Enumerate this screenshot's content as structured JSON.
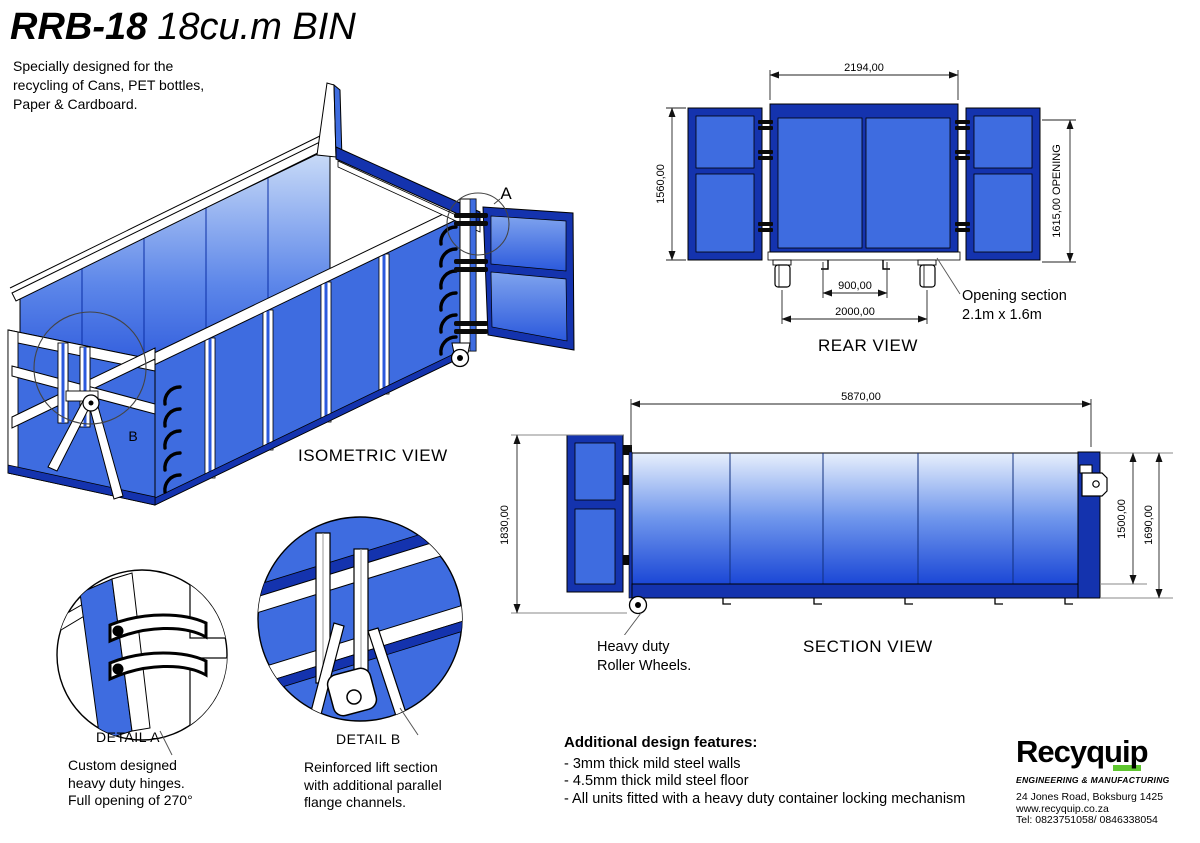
{
  "title": {
    "model": "RRB-18",
    "capacity": "18cu.m BIN"
  },
  "description": "Specially designed for the\nrecycling of Cans, PET bottles,\nPaper & Cardboard.",
  "views": {
    "isometric": {
      "label": "ISOMETRIC VIEW",
      "marker_a": "A",
      "marker_b": "B"
    },
    "rear": {
      "label": "REAR VIEW",
      "dim_width": "2194,00",
      "dim_height": "1560,00",
      "dim_opening": "1615,00 OPENING",
      "dim_wheel_inner": "900,00",
      "dim_wheel_outer": "2000,00",
      "callout": "Opening section\n2.1m x 1.6m"
    },
    "section": {
      "label": "SECTION VIEW",
      "dim_length": "5870,00",
      "dim_height_overall": "1830,00",
      "dim_height_inner": "1500,00",
      "dim_height_outer": "1690,00",
      "callout": "Heavy duty\nRoller Wheels."
    }
  },
  "details": {
    "a": {
      "label": "DETAIL A",
      "text": "Custom designed\nheavy duty hinges.\nFull opening of 270°"
    },
    "b": {
      "label": "DETAIL  B",
      "text": "Reinforced lift section\nwith additional parallel\nflange channels."
    }
  },
  "features": {
    "heading": "Additional design features:",
    "items": [
      "- 3mm thick mild steel walls",
      "- 4.5mm thick mild steel floor",
      "- All units fitted with a heavy duty container locking mechanism"
    ]
  },
  "logo": {
    "name": "Recyquip",
    "tagline": "ENGINEERING & MANUFACTURING",
    "address": "24 Jones Road, Boksburg 1425",
    "website": "www.recyquip.co.za",
    "phone": "Tel: 0823751058/ 0846338054"
  },
  "colors": {
    "frame_blue": "#1433ae",
    "panel_blue": "#3e6ce0",
    "gradient_top": "#e7effc",
    "gradient_bottom": "#1b47d6",
    "logo_green": "#5fc72f"
  }
}
